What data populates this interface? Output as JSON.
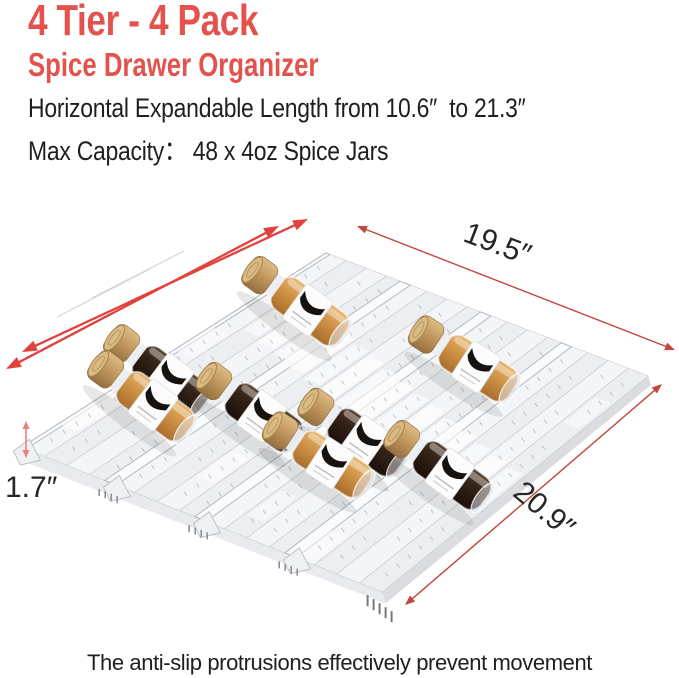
{
  "header": {
    "title": "4 Tier - 4 Pack",
    "subtitle": "Spice Drawer Organizer",
    "feature_line": "Horizontal Expandable Length from 10.6″  to 21.3″",
    "capacity_line": "Max Capacity： 48 x 4oz Spice Jars"
  },
  "dimensions": {
    "top_width": "19.5″",
    "front_height": "1.7″",
    "side_depth": "20.9″"
  },
  "caption": "The anti-slip protrusions effectively prevent movement",
  "colors": {
    "accent_red": "#e4524e",
    "expand_arrow_red": "#e0423d",
    "dimension_line_red": "#c2463c",
    "height_arrow_pink": "#e8817c",
    "text_dark": "#1f1f1f",
    "tray_light": "#f4f5f7",
    "tray_shade": "#eceef1",
    "jar_tan": "#cf9347",
    "jar_dark": "#342317",
    "cap_bamboo": "#bf945b"
  }
}
